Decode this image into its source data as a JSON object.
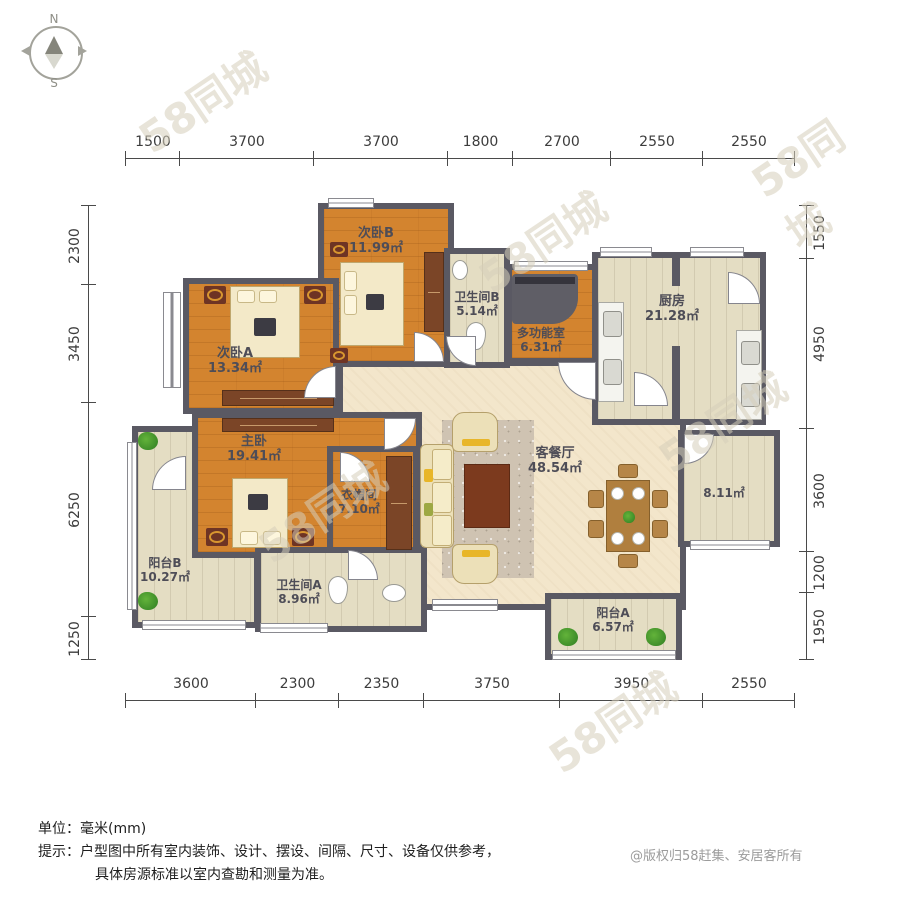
{
  "compass": {
    "north": "N",
    "south": "S"
  },
  "dims": {
    "top": [
      "1500",
      "3700",
      "3700",
      "1800",
      "2700",
      "2550",
      "2550"
    ],
    "bottom": [
      "3600",
      "2300",
      "2350",
      "3750",
      "3950",
      "2550"
    ],
    "left": [
      "2300",
      "3450",
      "6250",
      "1250"
    ],
    "right": [
      "1550",
      "4950",
      "3600",
      "1200",
      "1950"
    ]
  },
  "rooms": {
    "bedroomA": {
      "name": "次卧A",
      "area": "13.34㎡"
    },
    "bedroomB": {
      "name": "次卧B",
      "area": "11.99㎡"
    },
    "bathroomB": {
      "name": "卫生间B",
      "area": "5.14㎡"
    },
    "multiroom": {
      "name": "多功能室",
      "area": "6.31㎡"
    },
    "kitchen": {
      "name": "厨房",
      "area": "21.28㎡"
    },
    "master": {
      "name": "主卧",
      "area": "19.41㎡"
    },
    "closet": {
      "name": "衣帽间",
      "area": "7.10㎡"
    },
    "living": {
      "name": "客餐厅",
      "area": "48.54㎡"
    },
    "room811": {
      "name": "",
      "area": "8.11㎡"
    },
    "balconyB": {
      "name": "阳台B",
      "area": "10.27㎡"
    },
    "bathroomA": {
      "name": "卫生间A",
      "area": "8.96㎡"
    },
    "balconyA": {
      "name": "阳台A",
      "area": "6.57㎡"
    }
  },
  "notes": {
    "line1_label": "单位：",
    "line1_value": "毫米(mm)",
    "line2_label": "提示：",
    "line2_value": "户型图中所有室内装饰、设计、摆设、间隔、尺寸、设备仅供参考，",
    "line3_value": "具体房源标准以室内查勘和测量为准。"
  },
  "copyright": "@版权归58赶集、安居客所有",
  "watermark": "58同城",
  "colors": {
    "wall": "#5a5963",
    "wood_floor": "#d3842f",
    "tile_floor": "#e4ddc3",
    "living_floor": "#f3e6cb",
    "label_text": "#4e4d57"
  }
}
